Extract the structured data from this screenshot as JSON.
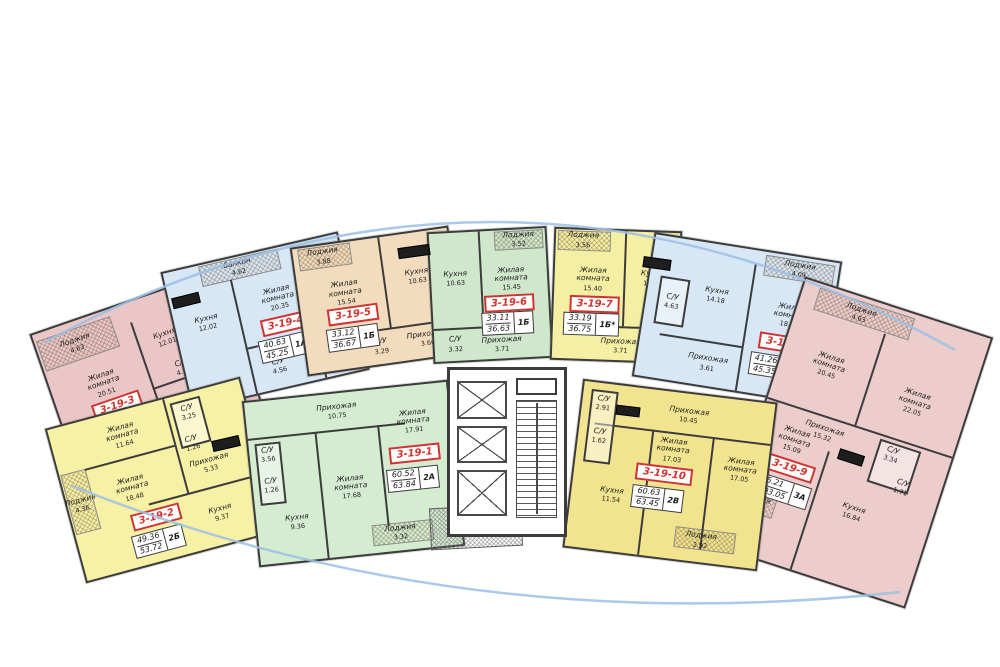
{
  "colors": {
    "wall": "#3c3c3c",
    "badge_red": "#cf3434",
    "glazing_blue": "#9cc0e4",
    "apt_pink": "#eac6c6",
    "apt_blue": "#d8e7f5",
    "apt_tan": "#f2dcbd",
    "apt_green": "#d4ecd0",
    "apt_yellow": "#f7f1a6",
    "apt_gold": "#f2e48e"
  },
  "core": {
    "elevator_shafts": 3
  },
  "apartments": [
    {
      "number": "3-19-1",
      "area_living": "60.52",
      "area_total": "63.84",
      "type": "2А",
      "color": "#d4ecd0",
      "rooms": [
        {
          "name": "Прихожая",
          "area": "10.75"
        },
        {
          "name": "Жилая комната",
          "area": "17.68"
        },
        {
          "name": "Жилая комната",
          "area": "17.91"
        },
        {
          "name": "Кухня",
          "area": "9.36"
        },
        {
          "name": "С/У",
          "area": "3.56"
        },
        {
          "name": "С/У",
          "area": "1.26"
        },
        {
          "name": "Лоджия",
          "area": "3.32"
        }
      ]
    },
    {
      "number": "3-19-2",
      "area_living": "49.36",
      "area_total": "53.72",
      "type": "2Б",
      "color": "#f7f1a6",
      "rooms": [
        {
          "name": "Жилая комната",
          "area": "11.64"
        },
        {
          "name": "Жилая комната",
          "area": "18.48"
        },
        {
          "name": "Кухня",
          "area": "9.37"
        },
        {
          "name": "Прихожая",
          "area": "5.33"
        },
        {
          "name": "С/У",
          "area": "3.25"
        },
        {
          "name": "С/У",
          "area": "1.26"
        },
        {
          "name": "Лоджия",
          "area": "4.36"
        }
      ]
    },
    {
      "number": "3-19-3",
      "area_living": "40.79",
      "area_total": "45.42",
      "type": "1А",
      "color": "#eac6c6",
      "rooms": [
        {
          "name": "Жилая комната",
          "area": "20.51"
        },
        {
          "name": "Кухня",
          "area": "12.01"
        },
        {
          "name": "Прихожая",
          "area": "3.71"
        },
        {
          "name": "С/У",
          "area": "4.56"
        },
        {
          "name": "Лоджия",
          "area": "4.63"
        }
      ]
    },
    {
      "number": "3-19-4",
      "area_living": "40.63",
      "area_total": "45.25",
      "type": "1А*",
      "color": "#d8e7f5",
      "rooms": [
        {
          "name": "Жилая комната",
          "area": "20.35"
        },
        {
          "name": "Кухня",
          "area": "12.02"
        },
        {
          "name": "Прихожая",
          "area": "3.70"
        },
        {
          "name": "С/У",
          "area": "4.56"
        },
        {
          "name": "балкон",
          "area": "4.62"
        }
      ]
    },
    {
      "number": "3-19-5",
      "area_living": "33.12",
      "area_total": "36.67",
      "type": "1Б",
      "color": "#f2dcbd",
      "rooms": [
        {
          "name": "Жилая комната",
          "area": "15.54"
        },
        {
          "name": "Кухня",
          "area": "10.63"
        },
        {
          "name": "Прихожая",
          "area": "3.66"
        },
        {
          "name": "С/У",
          "area": "3.29"
        },
        {
          "name": "Лоджия",
          "area": "3.88"
        }
      ]
    },
    {
      "number": "3-19-6",
      "area_living": "33.11",
      "area_total": "36.63",
      "type": "1Б",
      "color": "#cfe7cb",
      "rooms": [
        {
          "name": "Кухня",
          "area": "10.63"
        },
        {
          "name": "Жилая комната",
          "area": "15.45"
        },
        {
          "name": "Прихожая",
          "area": "3.71"
        },
        {
          "name": "С/У",
          "area": "3.32"
        },
        {
          "name": "Лоджия",
          "area": "3.52"
        }
      ]
    },
    {
      "number": "3-19-7",
      "area_living": "33.19",
      "area_total": "36.75",
      "type": "1Б*",
      "color": "#f5efa3",
      "rooms": [
        {
          "name": "Жилая комната",
          "area": "15.40"
        },
        {
          "name": "Кухня",
          "area": "10.63"
        },
        {
          "name": "Прихожая",
          "area": "3.71"
        },
        {
          "name": "С/У",
          "area": "3.45"
        },
        {
          "name": "Лоджия",
          "area": "3.56"
        }
      ]
    },
    {
      "number": "3-19-8",
      "area_living": "41.26",
      "area_total": "45.35",
      "type": "1А*",
      "color": "#d8e7f5",
      "rooms": [
        {
          "name": "Кухня",
          "area": "14.18"
        },
        {
          "name": "Жилая комната",
          "area": "18.84"
        },
        {
          "name": "Прихожая",
          "area": "3.61"
        },
        {
          "name": "С/У",
          "area": "4.63"
        },
        {
          "name": "Лоджия",
          "area": "4.09"
        }
      ]
    },
    {
      "number": "3-19-9",
      "area_living": "95.21",
      "area_total": "103.05",
      "type": "3А",
      "color": "#eccdcc",
      "rooms": [
        {
          "name": "Жилая комната",
          "area": "20.45"
        },
        {
          "name": "Жилая комната",
          "area": "22.05"
        },
        {
          "name": "Жилая комната",
          "area": "15.09"
        },
        {
          "name": "Прихожая",
          "area": "15.32"
        },
        {
          "name": "Кухня",
          "area": "16.84"
        },
        {
          "name": "С/У",
          "area": "3.34"
        },
        {
          "name": "С/У",
          "area": "1.71"
        },
        {
          "name": "Лоджия",
          "area": "4.63"
        },
        {
          "name": "Лоджия",
          "area": "3.21"
        }
      ]
    },
    {
      "number": "3-19-10",
      "area_living": "60.63",
      "area_total": "63.45",
      "type": "2В",
      "color": "#f2e48e",
      "rooms": [
        {
          "name": "Прихожая",
          "area": "10.45"
        },
        {
          "name": "Жилая комната",
          "area": "17.03"
        },
        {
          "name": "Жилая комната",
          "area": "17.05"
        },
        {
          "name": "Кухня",
          "area": "11.54"
        },
        {
          "name": "С/У",
          "area": "2.91"
        },
        {
          "name": "С/У",
          "area": "1.62"
        },
        {
          "name": "Лоджия",
          "area": "2.92"
        }
      ]
    }
  ]
}
